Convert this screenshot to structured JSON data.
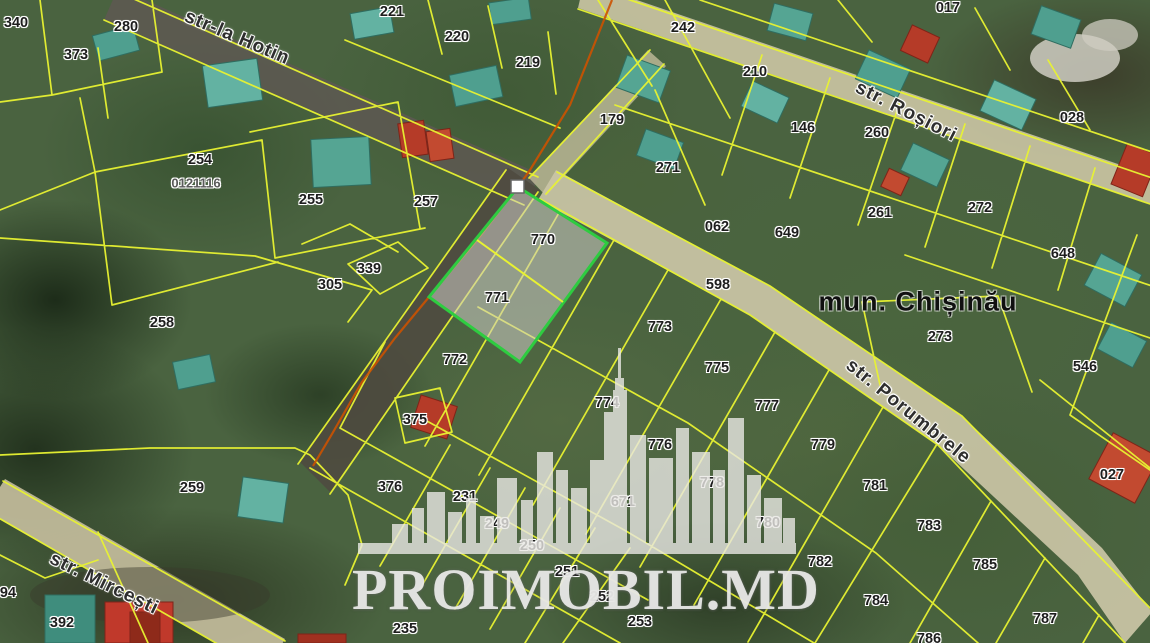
{
  "map": {
    "municipality_label": {
      "text": "mun. Chișinău",
      "x": 918,
      "y": 302
    },
    "watermark": {
      "text": "PROIMOBIL.MD"
    },
    "streets": [
      {
        "id": "hotin",
        "label": "str-la Hotin",
        "x": 237,
        "y": 38,
        "rotate": 23
      },
      {
        "id": "rosiori",
        "label": "str. Roșiori",
        "x": 906,
        "y": 112,
        "rotate": 27
      },
      {
        "id": "porumbrele",
        "label": "str. Porumbrele",
        "x": 908,
        "y": 412,
        "rotate": 39
      },
      {
        "id": "mircesti",
        "label": "str. Mircești",
        "x": 104,
        "y": 584,
        "rotate": 26
      }
    ],
    "highlighted_parcels": [
      "770",
      "771"
    ],
    "cadastral_code": "0121116",
    "parcel_labels": [
      {
        "text": "340",
        "x": 16,
        "y": 23
      },
      {
        "text": "373",
        "x": 76,
        "y": 55
      },
      {
        "text": "280",
        "x": 126,
        "y": 27
      },
      {
        "text": "254",
        "x": 200,
        "y": 160
      },
      {
        "text": "0121116",
        "x": 196,
        "y": 183,
        "muted": true
      },
      {
        "text": "255",
        "x": 311,
        "y": 200
      },
      {
        "text": "257",
        "x": 426,
        "y": 202
      },
      {
        "text": "339",
        "x": 369,
        "y": 269
      },
      {
        "text": "305",
        "x": 330,
        "y": 285
      },
      {
        "text": "258",
        "x": 162,
        "y": 323
      },
      {
        "text": "221",
        "x": 392,
        "y": 12
      },
      {
        "text": "220",
        "x": 457,
        "y": 37
      },
      {
        "text": "219",
        "x": 528,
        "y": 63
      },
      {
        "text": "242",
        "x": 683,
        "y": 28
      },
      {
        "text": "179",
        "x": 612,
        "y": 120
      },
      {
        "text": "271",
        "x": 668,
        "y": 168
      },
      {
        "text": "017",
        "x": 948,
        "y": 8
      },
      {
        "text": "210",
        "x": 755,
        "y": 72
      },
      {
        "text": "146",
        "x": 803,
        "y": 128
      },
      {
        "text": "260",
        "x": 877,
        "y": 133
      },
      {
        "text": "028",
        "x": 1072,
        "y": 118
      },
      {
        "text": "272",
        "x": 980,
        "y": 208
      },
      {
        "text": "261",
        "x": 880,
        "y": 213
      },
      {
        "text": "649",
        "x": 787,
        "y": 233
      },
      {
        "text": "062",
        "x": 717,
        "y": 227
      },
      {
        "text": "648",
        "x": 1063,
        "y": 254
      },
      {
        "text": "598",
        "x": 718,
        "y": 285
      },
      {
        "text": "273",
        "x": 940,
        "y": 337
      },
      {
        "text": "546",
        "x": 1085,
        "y": 367
      },
      {
        "text": "770",
        "x": 543,
        "y": 240
      },
      {
        "text": "771",
        "x": 497,
        "y": 298
      },
      {
        "text": "772",
        "x": 455,
        "y": 360
      },
      {
        "text": "773",
        "x": 660,
        "y": 327
      },
      {
        "text": "775",
        "x": 717,
        "y": 368
      },
      {
        "text": "777",
        "x": 767,
        "y": 406
      },
      {
        "text": "779",
        "x": 823,
        "y": 445
      },
      {
        "text": "781",
        "x": 875,
        "y": 486
      },
      {
        "text": "783",
        "x": 929,
        "y": 526
      },
      {
        "text": "785",
        "x": 985,
        "y": 565
      },
      {
        "text": "787",
        "x": 1045,
        "y": 619
      },
      {
        "text": "774",
        "x": 607,
        "y": 403
      },
      {
        "text": "776",
        "x": 660,
        "y": 445
      },
      {
        "text": "778",
        "x": 712,
        "y": 483
      },
      {
        "text": "780",
        "x": 768,
        "y": 523
      },
      {
        "text": "782",
        "x": 820,
        "y": 562
      },
      {
        "text": "784",
        "x": 876,
        "y": 601
      },
      {
        "text": "786",
        "x": 929,
        "y": 639
      },
      {
        "text": "671",
        "x": 623,
        "y": 502
      },
      {
        "text": "027",
        "x": 1112,
        "y": 475
      },
      {
        "text": "375",
        "x": 415,
        "y": 420
      },
      {
        "text": "376",
        "x": 390,
        "y": 487
      },
      {
        "text": "231",
        "x": 465,
        "y": 497
      },
      {
        "text": "249",
        "x": 497,
        "y": 524
      },
      {
        "text": "250",
        "x": 532,
        "y": 546
      },
      {
        "text": "251",
        "x": 567,
        "y": 572
      },
      {
        "text": "252",
        "x": 602,
        "y": 597
      },
      {
        "text": "253",
        "x": 640,
        "y": 622
      },
      {
        "text": "235",
        "x": 405,
        "y": 629
      },
      {
        "text": "259",
        "x": 192,
        "y": 488
      },
      {
        "text": "392",
        "x": 62,
        "y": 623
      },
      {
        "text": "94",
        "x": 8,
        "y": 593
      }
    ],
    "colors": {
      "highlight_green": "#2ecc40",
      "parcel_line": "#e8f231",
      "selected_boundary": "#cc5200",
      "road_tan": "#cbc5a6",
      "red_roof": "#b53b28",
      "label_text": "#1d1d1d"
    }
  }
}
